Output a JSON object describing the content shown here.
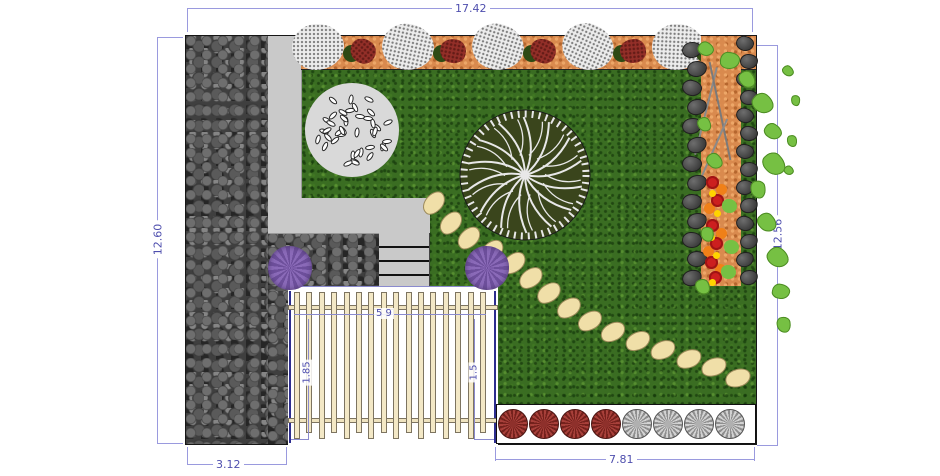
{
  "title": "Garden landscape plan",
  "dimensions": {
    "top": "17.42",
    "left": "12.60",
    "right": "12.56",
    "bottom_left": "3.12",
    "bottom_right": "7.81",
    "fence_width": "5 9",
    "fence_height_left": "1.85",
    "fence_height_right": "1.5"
  },
  "colors": {
    "dim_line": "#9a9ade",
    "dim_text": "#4f4fae",
    "plan_border": "#161616",
    "lawn_green": "#3a6d22",
    "gravel_gray": "#3f3f3f",
    "path_gray": "#c9c9c9",
    "mulch_orange": "#d98a4e",
    "tree_canopy": "#3a451c",
    "tree_veins": "#e8e8e8",
    "pebble_bed": "#d9d9d9",
    "stepping_stone": "#f0dfa8",
    "fence_wood": "#f3e8c6",
    "bush_purple": "#8a6ab8",
    "shrub_red": "#a8403a",
    "shrub_red_dark": "#74211c",
    "shrub_gray": "#d2d2d2",
    "shrub_gray_dark": "#8f8f8f",
    "flower_red": "#cc1f1f",
    "flower_orange": "#f08018",
    "flower_yellow": "#ffd400",
    "leaf_green": "#76c043",
    "boulder_gray": "#4e4e4e"
  },
  "elements": {
    "fence_slat_count": 16,
    "stepping_stone_count": 15,
    "pebble_count": 42,
    "purple_bush_count": 2,
    "bottom_shrubs": {
      "red_count": 4,
      "gray_count": 4
    },
    "top_bed": {
      "gray_shrub_count": 5,
      "red_flower_count": 5
    },
    "right_bed": {
      "red_flower_count": 6,
      "orange_flower_count": 5,
      "yellow_flower_count": 5,
      "leaf_count": 3
    }
  }
}
